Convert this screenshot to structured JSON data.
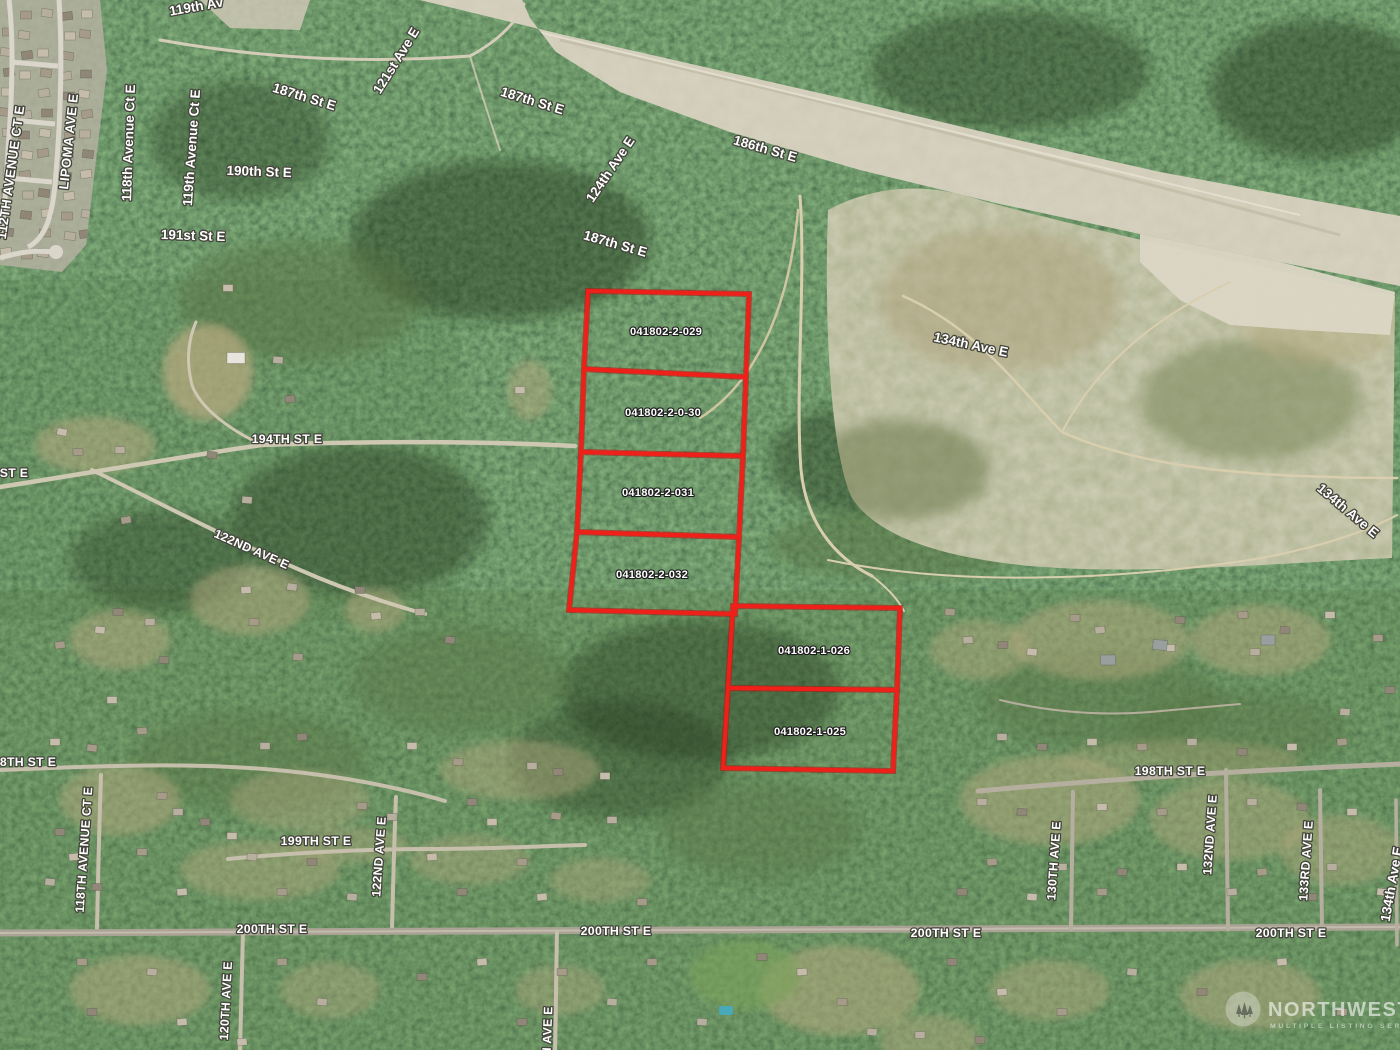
{
  "map": {
    "type": "aerial-satellite-parcel-map",
    "outline_color": "#ef2019",
    "label_color": "#ffffff",
    "parcels": [
      {
        "id": "041802-2-029"
      },
      {
        "id": "041802-2-0-30"
      },
      {
        "id": "041802-2-031"
      },
      {
        "id": "041802-2-032"
      },
      {
        "id": "041802-1-026"
      },
      {
        "id": "041802-1-025"
      }
    ],
    "street_labels": [
      {
        "text": "119th Av"
      },
      {
        "text": "112TH AVENUE CT E"
      },
      {
        "text": "LIPOMA AVE E"
      },
      {
        "text": "118th Avenue Ct E"
      },
      {
        "text": "119th Avenue Ct E"
      },
      {
        "text": "187th St E"
      },
      {
        "text": "190th St E"
      },
      {
        "text": "191st St E"
      },
      {
        "text": "121st Ave E"
      },
      {
        "text": "187th St E"
      },
      {
        "text": "124th Ave E"
      },
      {
        "text": "186th St E"
      },
      {
        "text": "187th St E"
      },
      {
        "text": "134th Ave E"
      },
      {
        "text": "134th Ave E"
      },
      {
        "text": "194TH ST E"
      },
      {
        "text": "ST E"
      },
      {
        "text": "122ND AVE E"
      },
      {
        "text": "8TH ST E"
      },
      {
        "text": "118TH AVENUE CT E"
      },
      {
        "text": "199TH ST E"
      },
      {
        "text": "122ND AVE E"
      },
      {
        "text": "200TH ST E"
      },
      {
        "text": "120TH AVE E"
      },
      {
        "text": "200TH ST E"
      },
      {
        "text": "124TH AVE E"
      },
      {
        "text": "200TH ST E"
      },
      {
        "text": "198TH ST E"
      },
      {
        "text": "130TH AVE E"
      },
      {
        "text": "132ND AVE E"
      },
      {
        "text": "133RD AVE E"
      },
      {
        "text": "200TH ST E"
      },
      {
        "text": "134th Ave E"
      }
    ]
  },
  "watermark": {
    "name": "NORTHWEST",
    "tagline": "MULTIPLE LISTING SERVICE"
  }
}
